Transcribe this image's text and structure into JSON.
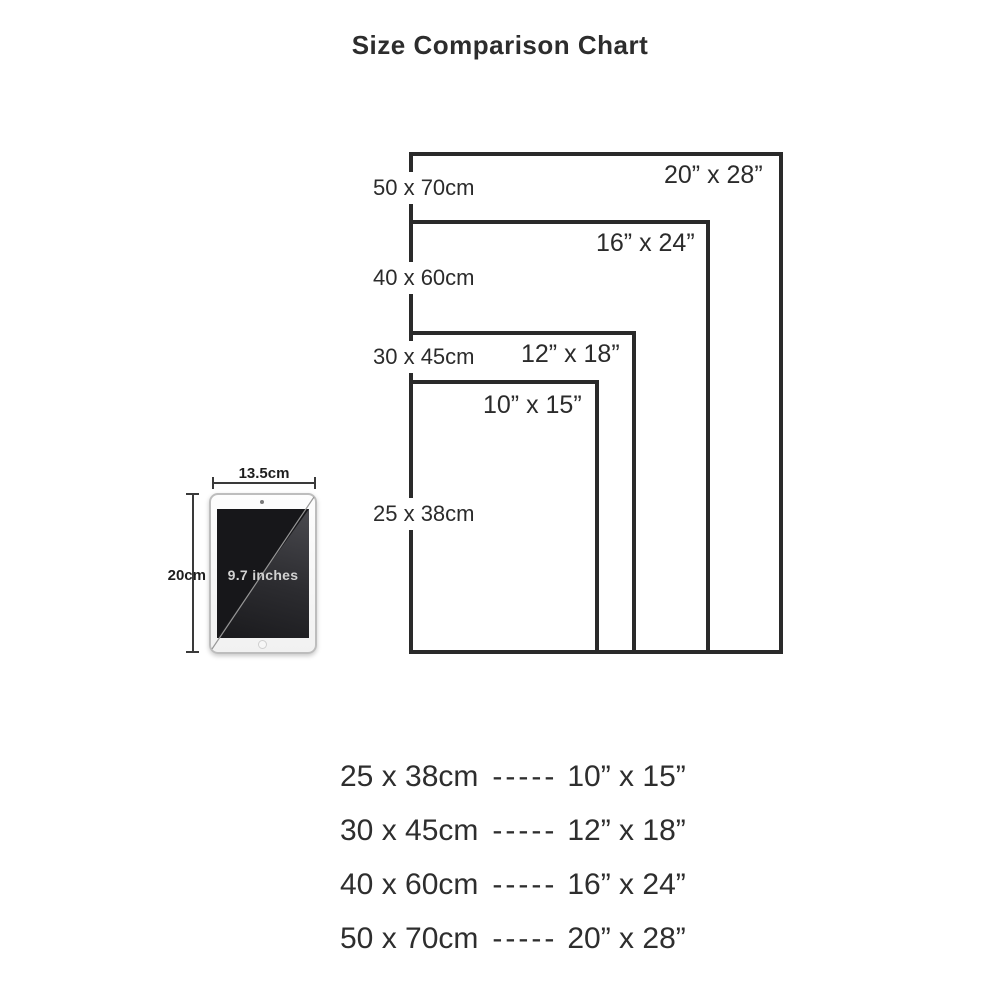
{
  "title": "Size Comparison Chart",
  "colors": {
    "line": "#2a2a2a",
    "text": "#2b2b2b",
    "tablet_screen": "#17171a"
  },
  "sizes": [
    {
      "cm_label": "50 x 70cm",
      "inch_label": "20” x 28”"
    },
    {
      "cm_label": "40 x 60cm",
      "inch_label": "16” x 24”"
    },
    {
      "cm_label": "30 x 45cm",
      "inch_label": "12” x 18”"
    },
    {
      "cm_label": "25 x 38cm",
      "inch_label": "10” x 15”"
    }
  ],
  "tablet": {
    "width_label": "13.5cm",
    "height_label": "20cm",
    "diagonal_label": "9.7 inches"
  },
  "legend": {
    "separator": "-----"
  }
}
